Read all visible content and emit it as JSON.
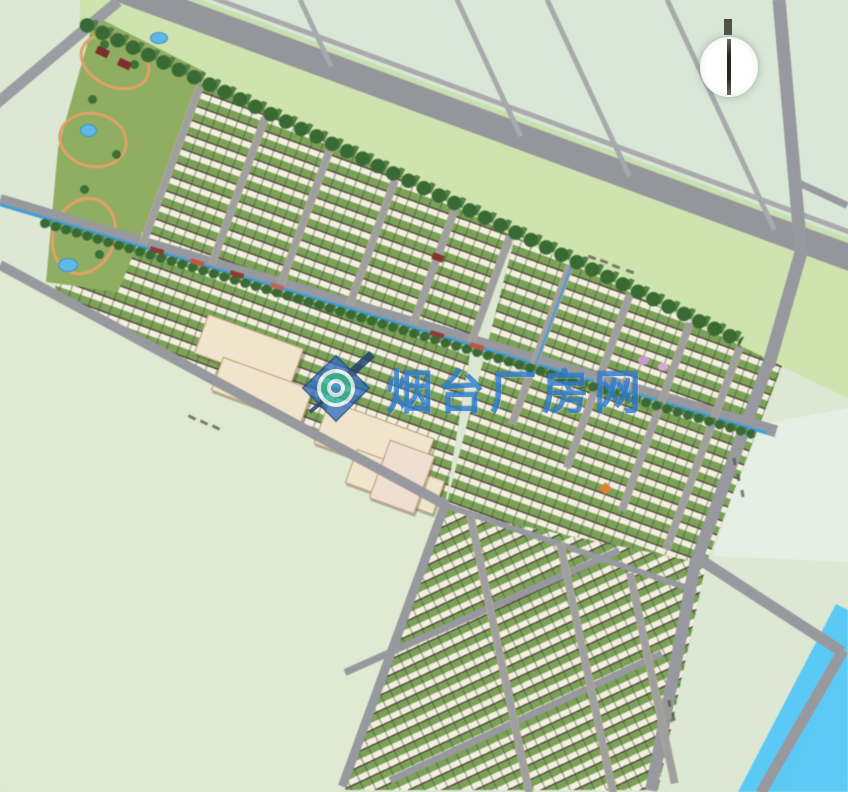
{
  "map": {
    "kind": "residential-development-master-plan",
    "watermark": {
      "text": "烟台厂房网",
      "logo_icon": "magnifier-diamond-logo-icon"
    },
    "compass": {
      "icon": "north-arrow-icon"
    }
  },
  "colors": {
    "field": "#dce8d4",
    "field_cool": "#d8e7d7",
    "field_warm": "#e0ead2",
    "road": "#97999e",
    "verge": "#cfe3ae",
    "tree": "#3a6a33",
    "block_green": "#7ca259",
    "building": "#f2efe0",
    "building_shadow": "#574a3e",
    "school": "#f0e4cc",
    "path_orange": "#e2a167",
    "water": "#49bdf0",
    "water_canal": "#3f9fe0",
    "watermark_blue": "#2d7cd2"
  }
}
